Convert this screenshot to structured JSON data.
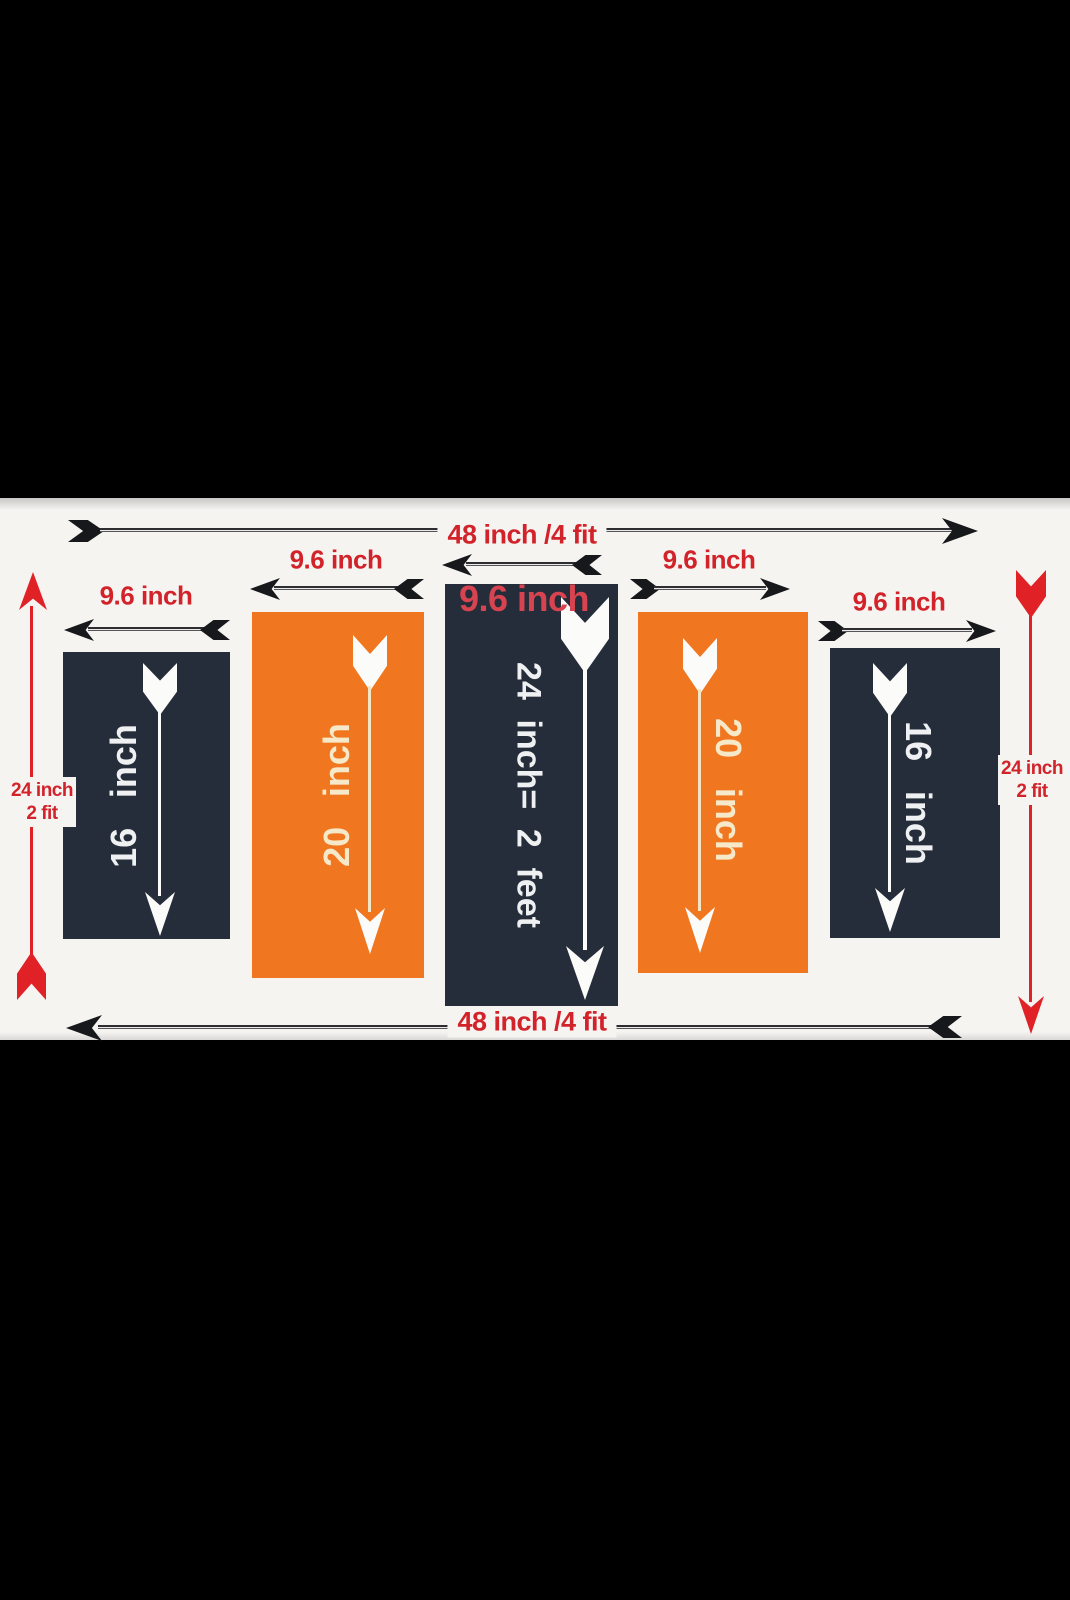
{
  "diagram": {
    "top_dimension_label": "48 inch /4 fit",
    "bottom_dimension_label": "48 inch /4 fit",
    "left_dimension": {
      "line1": "24 inch",
      "line2": "2 fit"
    },
    "right_dimension": {
      "line1": "24 inch",
      "line2": "2 fit"
    },
    "panels": [
      {
        "fill": "dark",
        "width_label": "9.6 inch",
        "height_label": "16 inch"
      },
      {
        "fill": "orange",
        "width_label": "9.6 inch",
        "height_label": "20 inch"
      },
      {
        "fill": "dark",
        "width_label": "9.6 inch",
        "height_label": "24 inch= 2 feet"
      },
      {
        "fill": "orange",
        "width_label": "9.6 inch",
        "height_label": "20 inch"
      },
      {
        "fill": "dark",
        "width_label": "9.6 inch",
        "height_label": "16 inch"
      }
    ],
    "colors": {
      "dark_panel": "#262d3a",
      "orange_panel": "#f0771f",
      "label_red": "#d2232b",
      "arrow_red": "#e02227",
      "canvas": "#f5f4f1",
      "letterbox": "#000000"
    }
  }
}
